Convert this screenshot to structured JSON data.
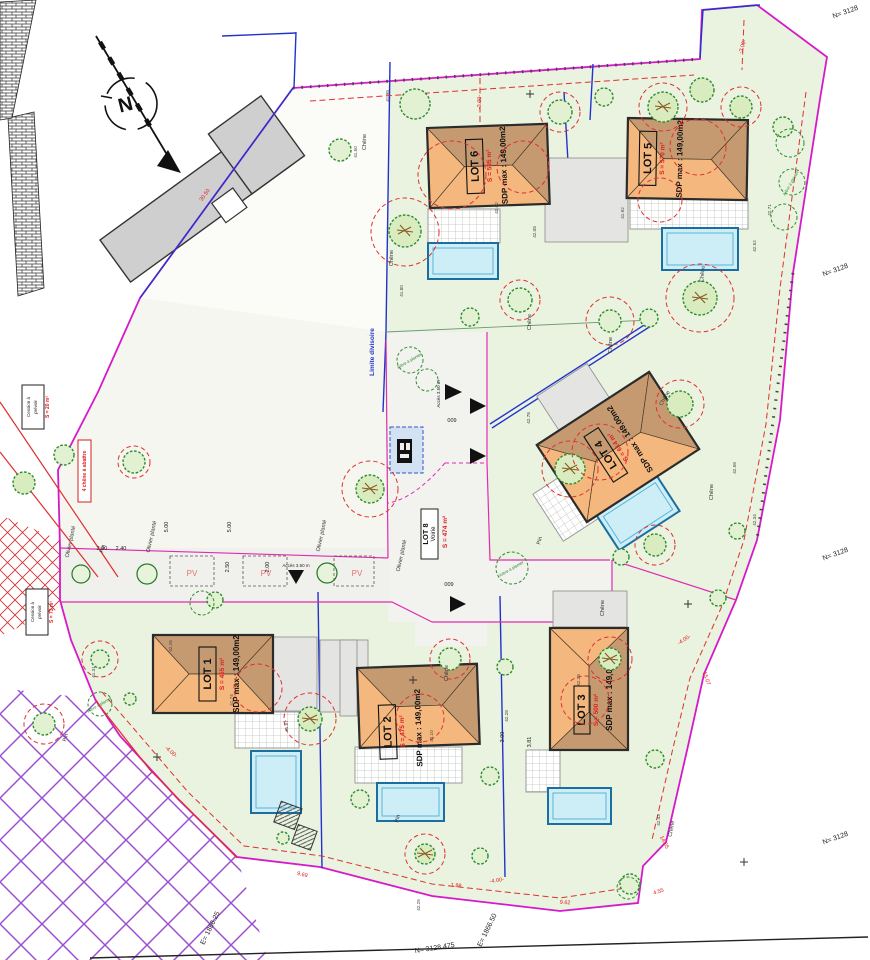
{
  "plan": {
    "compass_label": "N",
    "lots": [
      {
        "name": "LOT 1",
        "surface": "S = 455 m²",
        "sdp": "SDP max : 149,00m2"
      },
      {
        "name": "LOT 2",
        "surface": "S = 475 m²",
        "sdp": "SDP max : 149,00m2"
      },
      {
        "name": "LOT 3",
        "surface": "S = 500 m²",
        "sdp": "SDP max : 149,00m2"
      },
      {
        "name": "LOT 4",
        "surface": "S = 614 m²",
        "sdp": "SDP max : 149,00m2"
      },
      {
        "name": "LOT 5",
        "surface": "S = 570 m²",
        "sdp": "SDP max : 149,00m2"
      },
      {
        "name": "LOT 6",
        "surface": "S = 595 m²",
        "sdp": "SDP max : 149,00m2"
      }
    ],
    "road_lot": {
      "name": "LOT 8",
      "type": "Voirie",
      "surface": "S = 474 m²"
    },
    "parcel_numbers": {
      "road": "009",
      "upper": "009"
    },
    "labels": {
      "limite_divisoire": "Limite divisoire",
      "cession_l1": "Cession à",
      "cession_l2": "prévoir",
      "cession_s1": "S = 20 m²",
      "cession_s2": "S = 73 m²",
      "chene_abattre": "4 chêne à abattre",
      "olivier_plante": "Olivier planté",
      "arbre_a_planter": "Arbre à planter",
      "chene": "Chêne",
      "pin": "Pin",
      "pv": "PV",
      "acces": "Accès 3.50 m"
    },
    "coordinates": {
      "bottom_left_e": "E= 1866.25",
      "bottom_right_e": "E= 1866.50",
      "bottom_n": "N= 3128.475",
      "right_n": "N= 3128",
      "top_right_n": "N= 3128"
    },
    "dimensions": {
      "d30_50": "30.50",
      "d3_00s": "-3.00-",
      "d4_00s": "-4.00-",
      "d9_69": "9.69",
      "d9_62": "9.62",
      "d4_55": "4.55",
      "d15_07": "15.07",
      "d14_65": "14.65",
      "d2_00": "2.00",
      "d2_40": "2.40",
      "d5_00": "5.00",
      "d2_50": "2.50",
      "d3_00": "3.00",
      "d3_81": "3.81",
      "d1_88": "1.88"
    },
    "elevations": [
      "41.98",
      "41.50",
      "41.80",
      "42.02",
      "42.08",
      "41.92",
      "42.52",
      "42.71",
      "42.78",
      "42.58",
      "42.34",
      "42.26",
      "41.74",
      "41.57",
      "42.10",
      "42.28",
      "42.23",
      "42.43",
      "41.31",
      "42.25"
    ],
    "colors": {
      "boundary": "#d619c9",
      "divider_blue": "#2233cc",
      "roof_light": "#f4b87e",
      "roof_dark": "#c69a71",
      "pool": "#cdeef7",
      "garden": "#e9f3df",
      "protection_red": "#e03030",
      "hatch_purple": "#9b4fd0"
    }
  }
}
